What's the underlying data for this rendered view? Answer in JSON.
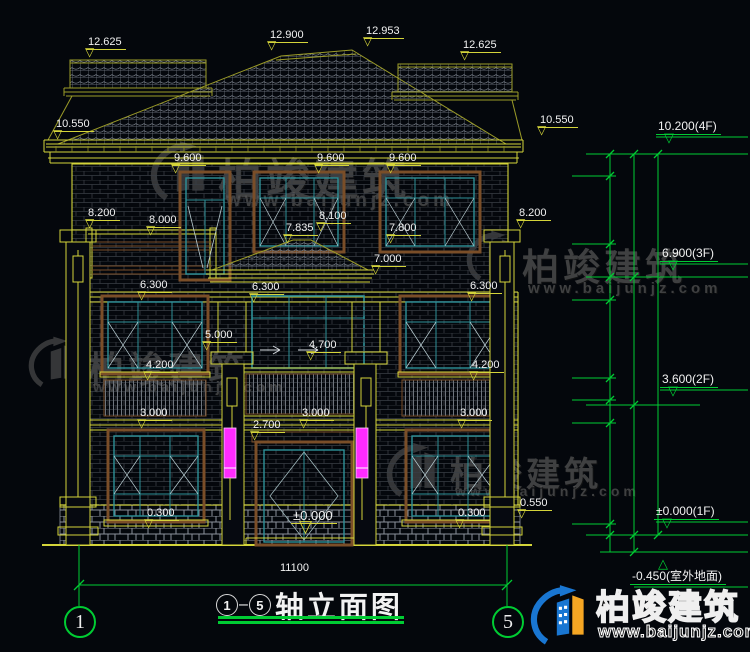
{
  "title_block": {
    "axis_from": "1",
    "dash": "–",
    "axis_to": "5",
    "name": "轴立面图"
  },
  "axis_bubbles": {
    "left": "1",
    "right": "5"
  },
  "watermark": {
    "brand": "柏竣建筑",
    "site": "www.baijunjz.com"
  },
  "colors": {
    "line_yellow": "#d4d43a",
    "line_green": "#00cc33",
    "window_teal": "#2e9199",
    "surround_brown": "#7a4e28",
    "accent_magenta": "#ff2bff",
    "text": "#f2f2f2"
  },
  "facade_labels": [
    {
      "t": "12.625",
      "x": 86,
      "y": 36,
      "m": "▽"
    },
    {
      "t": "12.900",
      "x": 268,
      "y": 29,
      "m": "▽"
    },
    {
      "t": "12.953",
      "x": 364,
      "y": 25,
      "m": "▽"
    },
    {
      "t": "12.625",
      "x": 461,
      "y": 39,
      "m": "▽"
    },
    {
      "t": "10.550",
      "x": 54,
      "y": 118,
      "m": "▽"
    },
    {
      "t": "10.550",
      "x": 538,
      "y": 114,
      "m": "▽"
    },
    {
      "t": "9.600",
      "x": 172,
      "y": 152,
      "m": "▽"
    },
    {
      "t": "9.600",
      "x": 315,
      "y": 152,
      "m": "▽"
    },
    {
      "t": "9.600",
      "x": 387,
      "y": 152,
      "m": "▽"
    },
    {
      "t": "8.200",
      "x": 86,
      "y": 207,
      "m": "▽"
    },
    {
      "t": "8.000",
      "x": 147,
      "y": 214,
      "m": "▽"
    },
    {
      "t": "8.100",
      "x": 317,
      "y": 210,
      "m": "▽"
    },
    {
      "t": "7.835",
      "x": 284,
      "y": 222,
      "m": "▽"
    },
    {
      "t": "7.800",
      "x": 387,
      "y": 222,
      "m": "▽"
    },
    {
      "t": "8.200",
      "x": 517,
      "y": 207,
      "m": "▽"
    },
    {
      "t": "7.000",
      "x": 372,
      "y": 253,
      "m": "▽"
    },
    {
      "t": "6.300",
      "x": 138,
      "y": 279,
      "m": "▽"
    },
    {
      "t": "6.300",
      "x": 250,
      "y": 281,
      "m": "▽"
    },
    {
      "t": "6.300",
      "x": 468,
      "y": 280,
      "m": "▽"
    },
    {
      "t": "5.000",
      "x": 203,
      "y": 329,
      "m": "▽"
    },
    {
      "t": "4.700",
      "x": 307,
      "y": 339,
      "m": "▽"
    },
    {
      "t": "4.200",
      "x": 144,
      "y": 359,
      "m": "▽"
    },
    {
      "t": "4.200",
      "x": 470,
      "y": 359,
      "m": "▽"
    },
    {
      "t": "3.000",
      "x": 138,
      "y": 407,
      "m": "▽"
    },
    {
      "t": "3.000",
      "x": 300,
      "y": 407,
      "m": "▽"
    },
    {
      "t": "3.000",
      "x": 458,
      "y": 407,
      "m": "▽"
    },
    {
      "t": "2.700",
      "x": 251,
      "y": 419,
      "m": "▽"
    },
    {
      "t": "0.300",
      "x": 145,
      "y": 507,
      "m": "▽"
    },
    {
      "t": "0.300",
      "x": 456,
      "y": 507,
      "m": "▽"
    },
    {
      "t": "0.550",
      "x": 518,
      "y": 497,
      "m": "▽"
    },
    {
      "t": "±0.000",
      "x": 291,
      "y": 510,
      "m": "▽",
      "cls": "big"
    },
    {
      "t": "11100",
      "x": 278,
      "y": 562,
      "m": "",
      "cls": "plain"
    }
  ],
  "chain_dims": [
    {
      "t": "600",
      "x": 599,
      "y": 165
    },
    {
      "t": "1800",
      "x": 599,
      "y": 210
    },
    {
      "t": "900",
      "x": 599,
      "y": 260
    },
    {
      "t": "600",
      "x": 599,
      "y": 288
    },
    {
      "t": "2100",
      "x": 599,
      "y": 339
    },
    {
      "t": "600",
      "x": 599,
      "y": 389
    },
    {
      "t": "600",
      "x": 599,
      "y": 411
    },
    {
      "t": "2700",
      "x": 599,
      "y": 473
    },
    {
      "t": "300",
      "x": 599,
      "y": 532
    },
    {
      "t": "3300",
      "x": 623,
      "y": 215
    },
    {
      "t": "3300",
      "x": 623,
      "y": 340
    },
    {
      "t": "3600",
      "x": 623,
      "y": 468
    },
    {
      "t": "450",
      "x": 625,
      "y": 545
    },
    {
      "t": "10200",
      "x": 647,
      "y": 344
    }
  ],
  "chain_levels": [
    {
      "t": "10.200(4F)",
      "x": 656,
      "y": 120,
      "m": "▽"
    },
    {
      "t": "6.900(3F)",
      "x": 660,
      "y": 247,
      "m": "▽"
    },
    {
      "t": "3.600(2F)",
      "x": 660,
      "y": 373,
      "m": "▽"
    },
    {
      "t": "±0.000(1F)",
      "x": 654,
      "y": 505,
      "m": "▽"
    },
    {
      "t": "-0.450(室外地面)",
      "x": 630,
      "y": 570,
      "m": "△",
      "cls": "up"
    }
  ]
}
